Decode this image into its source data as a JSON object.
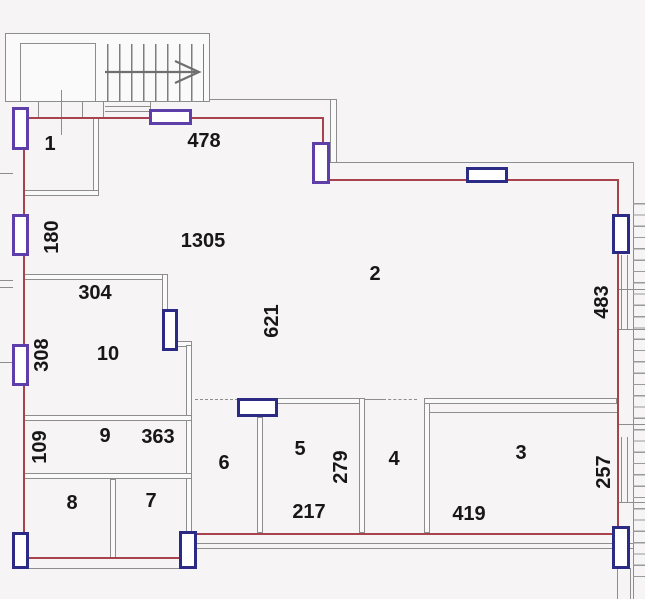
{
  "plan": {
    "type": "floor-plan",
    "rooms": {
      "r1": "1",
      "r2": "2",
      "r3": "3",
      "r4": "4",
      "r5": "5",
      "r6": "6",
      "r7": "7",
      "r8": "8",
      "r9": "9",
      "r10": "10"
    },
    "dims": {
      "d478": "478",
      "d1305": "1305",
      "d180": "180",
      "d304": "304",
      "d308": "308",
      "d621": "621",
      "d483": "483",
      "d109": "109",
      "d363": "363",
      "d279": "279",
      "d217": "217",
      "d419": "419",
      "d257": "257"
    },
    "colors": {
      "boundary": "#a8424c",
      "wall": "#8d8d8d",
      "window_navy": "#2b2b85",
      "window_purple": "#5e3ea8",
      "background": "#f6f4f4",
      "text": "#171717"
    }
  }
}
